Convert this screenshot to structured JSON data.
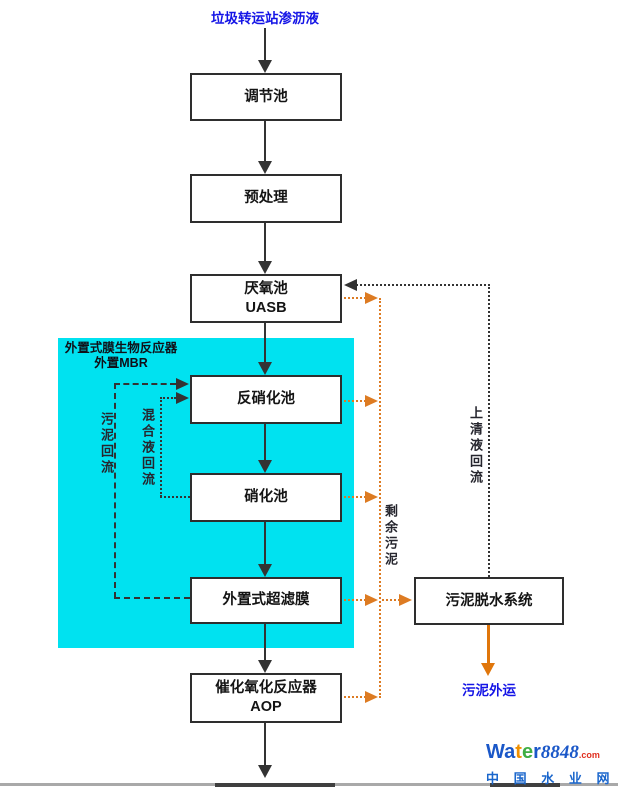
{
  "title": {
    "influent": "垃圾转运站渗沥液"
  },
  "flow_boxes": [
    {
      "label": "调节池"
    },
    {
      "label": "预处理"
    },
    {
      "label_line1": "厌氧池",
      "label_line2": "UASB"
    },
    {
      "label": "反硝化池"
    },
    {
      "label": "硝化池"
    },
    {
      "label": "外置式超滤膜"
    },
    {
      "label_line1": "催化氧化反应器",
      "label_line2": "AOP"
    },
    {
      "label": "污泥脱水系统"
    }
  ],
  "mbr_region": {
    "line1": "外置式膜生物反应器",
    "line2": "外置MBR"
  },
  "stream_labels": {
    "sludge_return": "污泥回流",
    "mixed_liquor_return": "混合液回流",
    "excess_sludge": "剩余污泥",
    "supernatant_return": "上清液回流",
    "sludge_disposal": "污泥外运"
  },
  "logo": {
    "wa": "Wa",
    "t": "t",
    "e": "e",
    "r": "r",
    "num": "8848",
    "dotcom": ".com",
    "cn": "中 国 水 业 网"
  },
  "colors": {
    "cyan": "#00e2f0",
    "orange": "#dd7b22",
    "orange-solid": "#e0760b",
    "blue": "#1414e6",
    "line": "#333333",
    "logo-blue": "#1a57c8",
    "logo-orange": "#f09000",
    "logo-green": "#3fae44",
    "logo-red": "#e03020",
    "logo-cn": "#1a66cc"
  }
}
